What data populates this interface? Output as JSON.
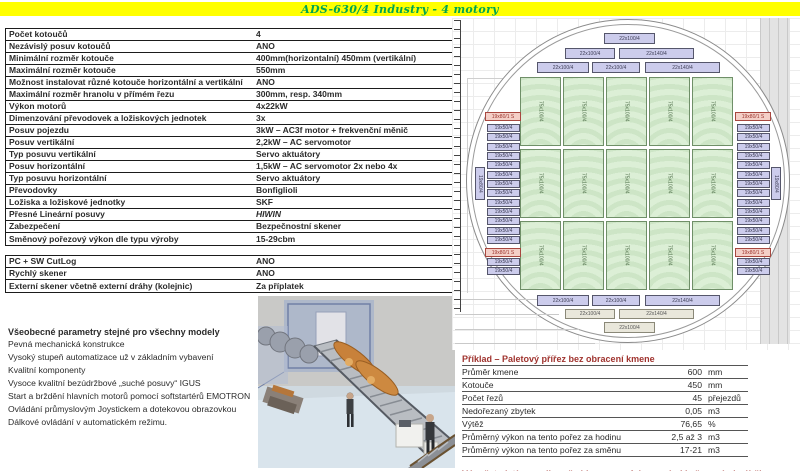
{
  "header": {
    "title": "ADS-630/4 Industry - 4 motory",
    "bg": "#ffff00",
    "accent": "#00a550"
  },
  "spec_table": {
    "rows": [
      [
        "Počet kotoučů",
        "4"
      ],
      [
        "Nezávislý posuv kotoučů",
        "ANO"
      ],
      [
        "Minimální rozměr kotouče",
        "400mm(horizontalní) 450mm (vertikální)"
      ],
      [
        "Maximální rozměr kotouče",
        "550mm"
      ],
      [
        "Možnost instalovat různé kotouče horizontální a vertikální",
        "ANO"
      ],
      [
        "Maximální rozměr hranolu v přímém řezu",
        "300mm, resp. 340mm"
      ],
      [
        "Výkon motorů",
        "4x22kW"
      ],
      [
        "Dimenzování převodovek a ložiskových jednotek",
        "3x"
      ],
      [
        "Posuv pojezdu",
        "3kW – AC3f motor + frekvenční měnič"
      ],
      [
        "Posuv vertikální",
        "2,2kW – AC servomotor"
      ],
      [
        "Typ posuvu vertikální",
        "Servo aktuátory"
      ],
      [
        "Posuv horizontální",
        "1,5kW – AC servomotor  2x nebo 4x"
      ],
      [
        "Typ posuvu horizontální",
        "Servo aktuátory"
      ],
      [
        "Převodovky",
        "Bonfiglioli"
      ],
      [
        "Ložiska a ložiskové jednotky",
        "SKF"
      ],
      [
        "Přesné Lineární posuvy",
        "HIWIN",
        "italic"
      ],
      [
        "Zabezpečení",
        "Bezpečnostní skener"
      ],
      [
        "Směnový pořezový výkon dle typu výroby",
        "15-29cbm"
      ]
    ]
  },
  "options_table": {
    "rows": [
      [
        "PC + SW CutLog",
        "ANO"
      ],
      [
        "Rychlý skener",
        "ANO"
      ],
      [
        "Externí skener včetně externí dráhy (kolejnic)",
        "Za příplatek"
      ]
    ]
  },
  "general": {
    "title": "Všeobecné parametry stejné pro všechny modely",
    "lines": [
      "Pevná mechanická konstrukce",
      "Vysoký stupeň automatizace už v základním vybavení",
      "Kvalitní komponenty",
      "Vysoce kvalitní bezúdržbové „suché posuvy“  IGUS",
      "Start a brždění hlavních motorů pomocí softstartérů EMOTRON",
      "Ovládání průmyslovým Joystickem a dotekovou obrazovkou",
      "Dálkové ovládání v automatickém režimu."
    ]
  },
  "example_table": {
    "title": "Příklad – Paletový přířez bez obracení kmene",
    "rows": [
      [
        "Průměr kmene",
        "600",
        "mm"
      ],
      [
        "Kotouče",
        "450",
        "mm"
      ],
      [
        "Počet řezů",
        "45",
        "přejezdů"
      ],
      [
        "Nedořezaný zbytek",
        "0,05",
        "m3"
      ],
      [
        "Výtěž",
        "76,65",
        "%"
      ],
      [
        "Průměrný výkon na tento pořez za hodinu",
        "2,5 až 3",
        "m3"
      ],
      [
        "Průměrný výkon na tento pořez za směnu",
        "17-21",
        "m3"
      ]
    ],
    "footnote": "Výpočet platí pro odkorněné kmeny s ofrézovanými kořenovými náběhy",
    "accent": "#a0342f"
  },
  "diagram": {
    "labels": {
      "green_block": "75x100/4",
      "side_board": "19x50/4",
      "side_board_pink": "19x80/1 S",
      "side_board_rotated": "19x80/4",
      "board_100": "22x100/4",
      "board_140": "22x140/4"
    },
    "colors": {
      "board_purple": "#ccccec",
      "board_beige": "#e9e7db",
      "board_pink": "#f4cfc7",
      "block_green": "#d9ecd3"
    }
  }
}
